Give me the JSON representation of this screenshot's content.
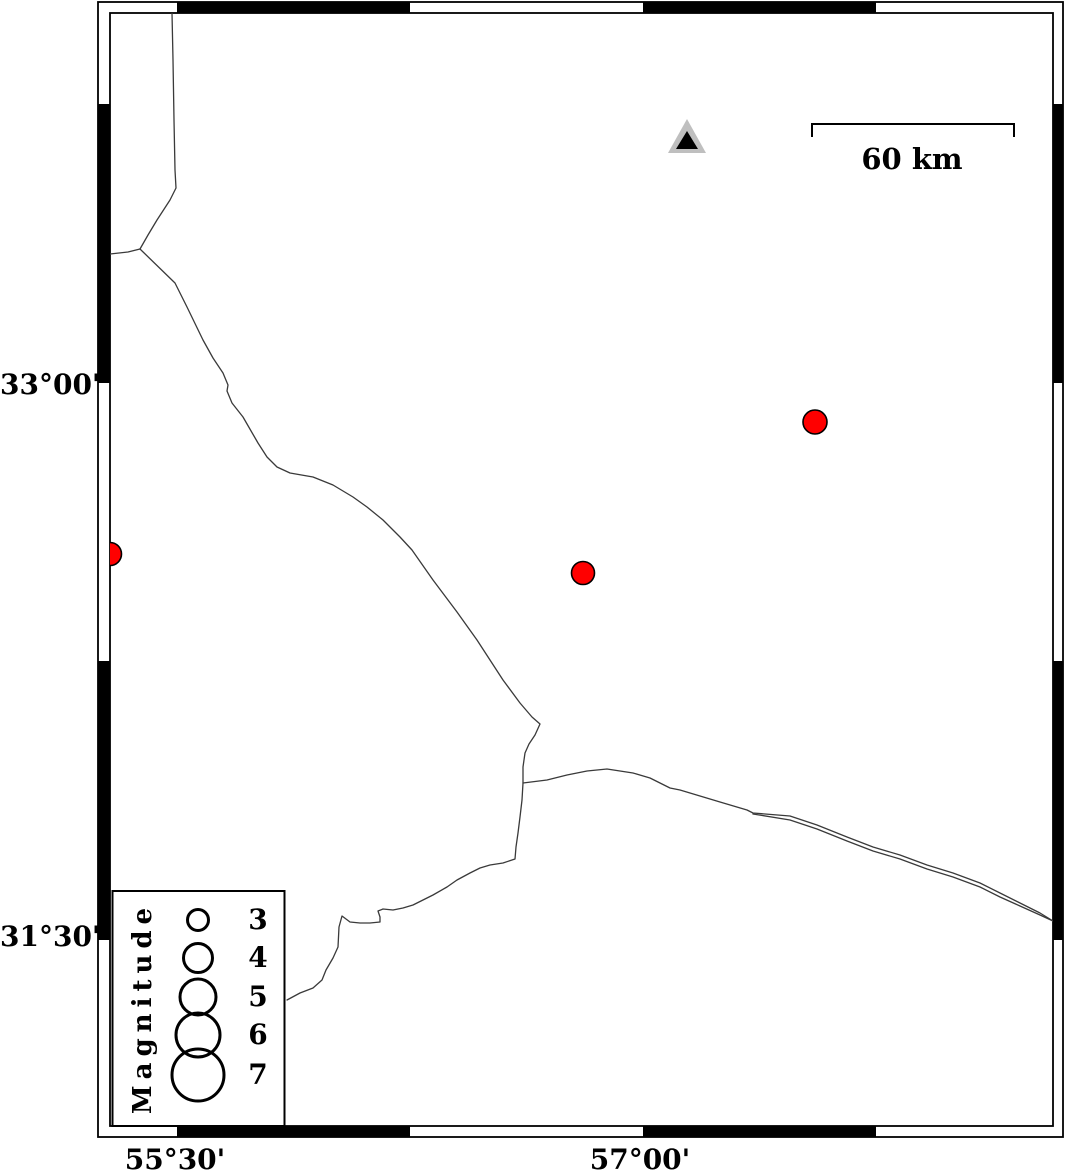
{
  "figure": {
    "type": "seismicity-map",
    "background": "#ffffff"
  },
  "axes": {
    "left_labels": [
      {
        "text": "33°00'"
      },
      {
        "text": "31°30'"
      }
    ],
    "bottom_labels": [
      {
        "text": "55°30'"
      },
      {
        "text": "57°00'"
      }
    ]
  },
  "scale_bar": {
    "label": "60 km"
  },
  "legend": {
    "title": "Magnitude",
    "circle_cx": 198,
    "entries": [
      {
        "label": "3",
        "cy": 920,
        "radius_px": 10.5
      },
      {
        "label": "4",
        "cy": 958,
        "radius_px": 14.5
      },
      {
        "label": "5",
        "cy": 997,
        "radius_px": 18
      },
      {
        "label": "6",
        "cy": 1035,
        "radius_px": 22
      },
      {
        "label": "7",
        "cy": 1075,
        "radius_px": 26
      }
    ]
  },
  "markers": {
    "station": {
      "shape": "triangle",
      "fill": "#bfbfbf",
      "inner_fill": "#000000",
      "px": {
        "x": 687,
        "y": 140
      },
      "approx_lon": "57.1E",
      "approx_lat": "33.7N"
    },
    "earthquake_color": "#ff0000",
    "earthquakes": [
      {
        "px": {
          "x": 815,
          "y": 422
        },
        "radius_px": 12,
        "approx_lon": "57.6E",
        "approx_lat": "32.9N"
      },
      {
        "px": {
          "x": 583,
          "y": 573
        },
        "radius_px": 11.5,
        "approx_lon": "56.8E",
        "approx_lat": "32.5N"
      },
      {
        "px": {
          "x": 110,
          "y": 554
        },
        "radius_px": 11.5,
        "approx_lon": "55.3E",
        "approx_lat": "32.5N"
      }
    ]
  },
  "colors": {
    "frame": "#000000",
    "boundary_line": "#3a3a3a",
    "station_gray": "#bfbfbf",
    "quake_red": "#ff0000"
  }
}
